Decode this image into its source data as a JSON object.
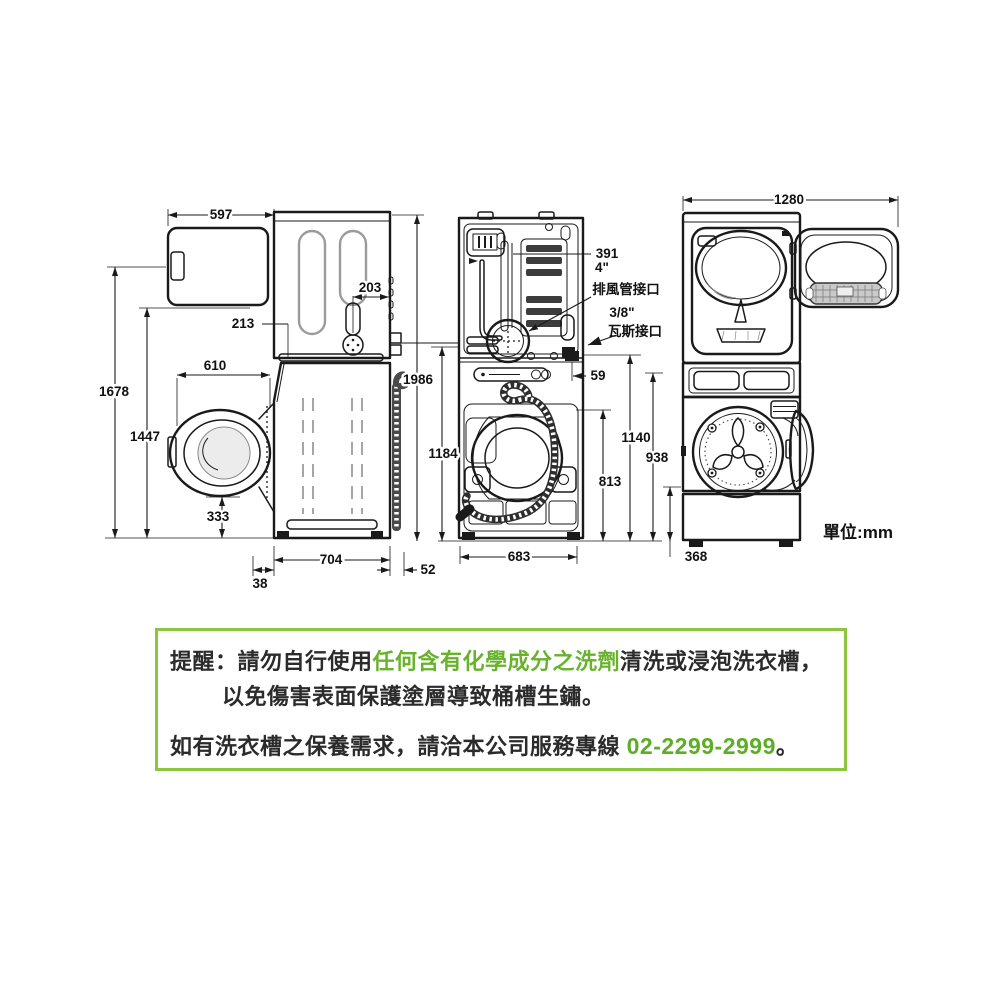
{
  "diagram": {
    "unit_label": "單位:mm",
    "dims": {
      "d597": "597",
      "d203": "203",
      "d213": "213",
      "d610": "610",
      "d1678": "1678",
      "d1447": "1447",
      "d333": "333",
      "d704": "704",
      "d38": "38",
      "d52": "52",
      "d1986": "1986",
      "d1184": "1184",
      "d391": "391",
      "d59": "59",
      "d683": "683",
      "d813": "813",
      "d1140": "1140",
      "d938": "938",
      "d1280": "1280",
      "d368": "368"
    },
    "labels": {
      "exhaust_size": "4\"",
      "exhaust_port": "排風管接口",
      "gas_size": "3/8\"",
      "gas_port": "瓦斯接口"
    }
  },
  "notice": {
    "line1_prefix": "提醒：請勿自行使用",
    "line1_highlight": "任何含有化學成分之洗劑",
    "line1_suffix": "清洗或浸泡洗衣槽，",
    "line2": "以免傷害表面保護塗層導致桶槽生鏽。",
    "line3_prefix": "如有洗衣槽之保養需求，請洽本公司服務專線 ",
    "line3_phone": "02-2299-2999",
    "line3_suffix": "。"
  },
  "colors": {
    "accent_green": "#68b22c",
    "border_green": "#8cc63e",
    "line_black": "#1a1a1a"
  }
}
